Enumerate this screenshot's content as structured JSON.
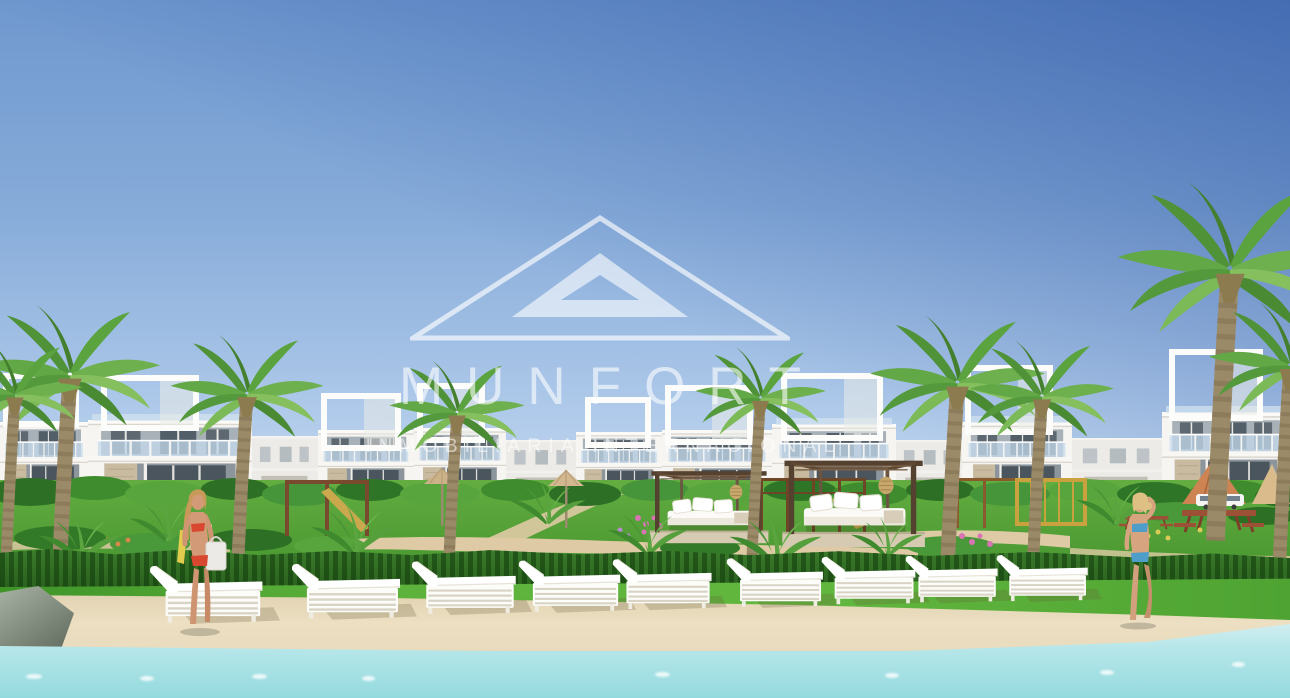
{
  "watermark": {
    "logo": "double-triangle-icon",
    "brand": "MUNFORT",
    "tagline": "INMOBILIARIA INTERNACIONAL",
    "color": "#FFFFFF"
  },
  "scene": {
    "subject": "seafront resort apartment complex render with pool terrace",
    "sun_loungers_count": 9,
    "cabanas_count": 2,
    "people": [
      {
        "position": "left",
        "swimsuit_color": "#D8472F"
      },
      {
        "position": "right",
        "swimsuit_color": "#4F9DC9"
      }
    ],
    "palette": {
      "sky_top": "#3C69B8",
      "sky_horizon": "#C9DCF2",
      "building_white": "#F6F5F1",
      "lawn_green": "#4EA732",
      "hedge_green": "#2E6F23",
      "deck_sand": "#EADBBB",
      "pool_water": "#A5E0E4",
      "cabana_wood": "#55412F",
      "palm_green": "#5AA33F",
      "watermark_white": "#FFFFFF"
    }
  }
}
